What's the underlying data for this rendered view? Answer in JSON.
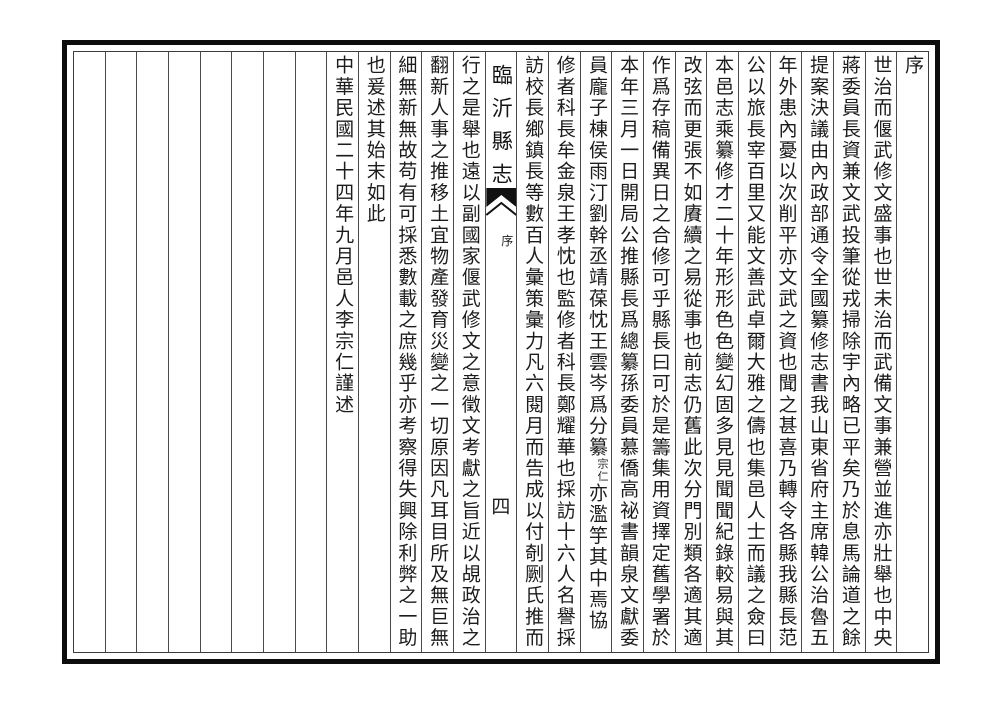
{
  "page": {
    "title": "臨沂縣志",
    "section": "序",
    "page_number": "四"
  },
  "colors": {
    "paper": "#ffffff",
    "frame": "#0d0d0d",
    "grid_line": "#4a4a4a",
    "ink": "#1c1c1c"
  },
  "columns": [
    {
      "text": "序"
    },
    {
      "text": "世治而偃武修文盛事也世未治而武備文事兼營並進亦壯舉也中央"
    },
    {
      "text": "蔣委員長資兼文武投筆從戎掃除宇內略已平矣乃於息馬論道之餘"
    },
    {
      "text": "提案決議由內政部通令全國纂修志書我山東省府主席韓公治魯五"
    },
    {
      "text": "年外患內憂以次削平亦文武之資也聞之甚喜乃轉令各縣我縣長范"
    },
    {
      "text": "公以旅長宰百里又能文善武卓爾大雅之儔也集邑人士而議之僉曰"
    },
    {
      "text": "本邑志乘纂修才二十年形形色色變幻固多見見聞聞紀錄較易與其"
    },
    {
      "text": "改弦而更張不如賡續之易從事也前志仍舊此次分門別類各適其適"
    },
    {
      "text": "作爲存稿備異日之合修可乎縣長曰可於是籌集用資擇定舊學署於"
    },
    {
      "text": "本年三月一日開局公推縣長爲總纂孫委員慕僑高祕書韻泉文獻委"
    },
    {
      "text": "員龐子棟侯雨汀劉幹丞靖葆忱王雲岑爲分纂",
      "small_note": "宗仁",
      "text_after": "亦濫竽其中焉協"
    },
    {
      "text": "修者科長牟金泉王孝忱也監修者科長鄭耀華也採訪十六人名譽採"
    },
    {
      "text": "訪校長鄉鎮長等數百人彙策彙力凡六閱月而告成以付剞劂氏推而"
    },
    {
      "fold": true
    },
    {
      "text": "行之是舉也遠以副國家偃武修文之意徵文考獻之旨近以覘政治之"
    },
    {
      "text": "翻新人事之推移土宜物產發育災變之一切原因凡耳目所及無巨無"
    },
    {
      "text": "細無新無故苟有可採悉數載之庶幾乎亦考察得失興除利弊之一助"
    },
    {
      "text": "也爰述其始末如此"
    },
    {
      "text": "中華民國二十四年九月邑人李宗仁謹述"
    },
    {
      "empty": true
    },
    {
      "empty": true
    },
    {
      "empty": true
    },
    {
      "empty": true
    },
    {
      "empty": true
    },
    {
      "empty": true
    },
    {
      "empty": true
    },
    {
      "empty": true
    }
  ]
}
